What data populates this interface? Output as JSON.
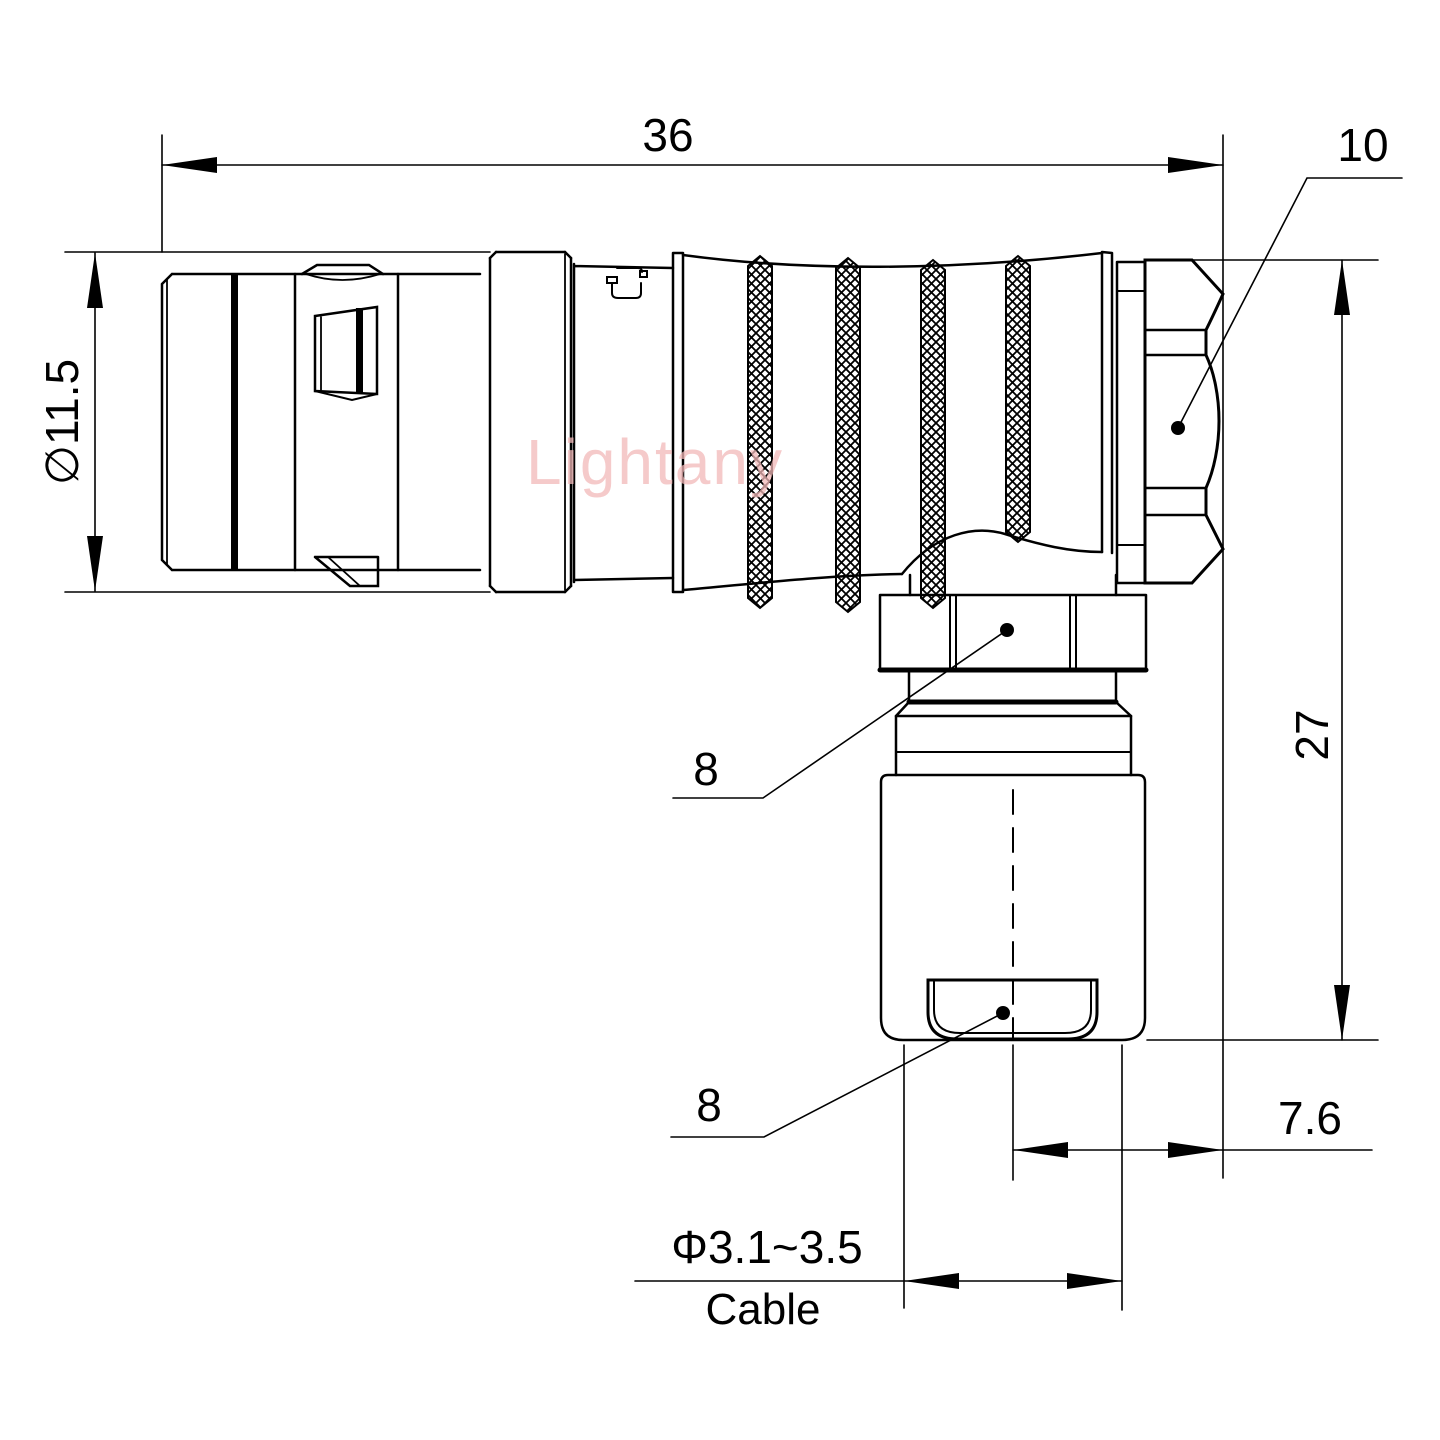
{
  "title": "Right-angle connector dimension drawing",
  "watermark": {
    "text": "Lightany",
    "color": "#f2b9b9"
  },
  "colors": {
    "line": "#000000",
    "background": "#ffffff"
  },
  "dimensions": {
    "total_length": "36",
    "nut_across_flats": "10",
    "shell_diameter": "∅11.5",
    "total_height": "27",
    "backnut_hex": "8",
    "clamp_hex": "8",
    "axis_offset": "7.6",
    "cable_diameter_range": "Φ3.1~3.5",
    "cable_label": "Cable"
  }
}
